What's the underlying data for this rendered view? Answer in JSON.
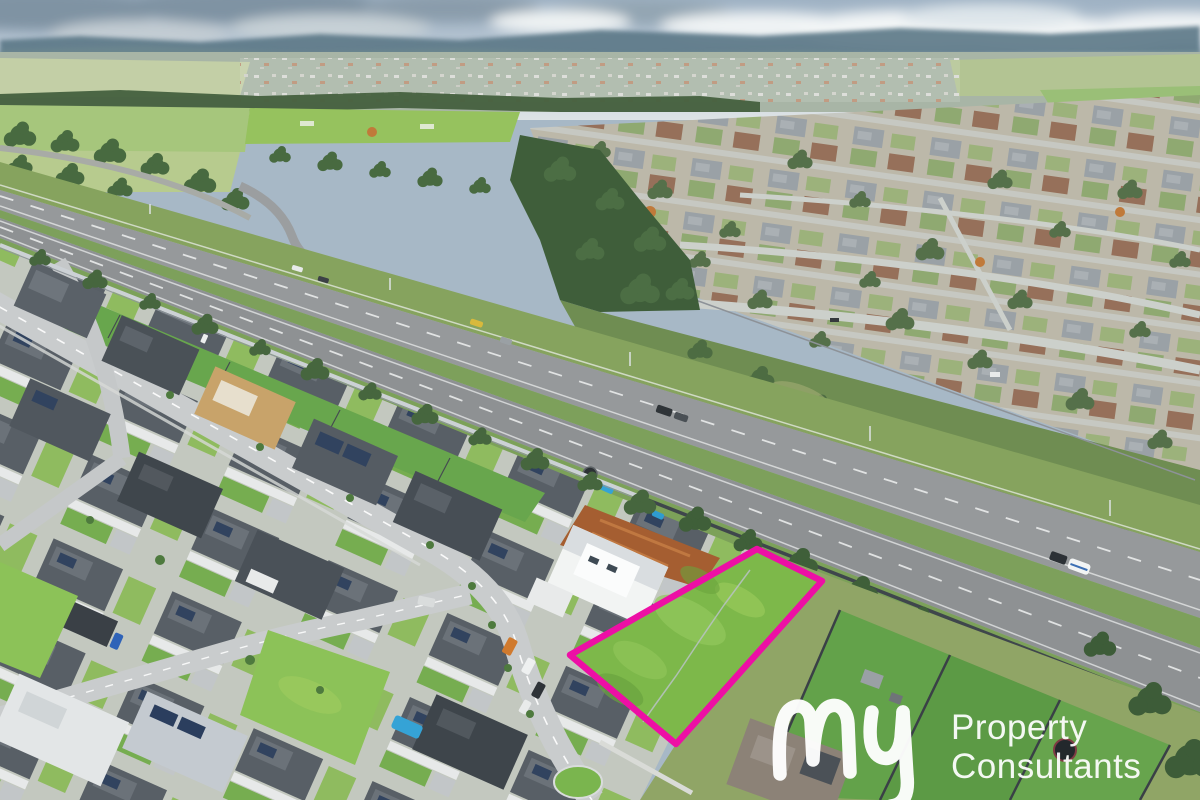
{
  "image": {
    "type": "aerial-drone-photograph",
    "description": "Aerial drone view of a new residential estate beside a divided highway, with an established suburb beyond, distant rural plains and hills under a partly cloudy sky. A vacant grass land lot in the foreground is outlined in bright magenta. A white real-estate watermark logo sits at bottom right.",
    "width": 1200,
    "height": 800
  },
  "watermark": {
    "script_word": "my",
    "line1": "Property",
    "line2": "Consultants",
    "color": "#ffffff"
  },
  "featured_lot": {
    "outline_color": "#ED0FA5",
    "fill_color": "#7db84a",
    "points": "757,549 822,581 676,744 570,655",
    "shape": "quadrilateral vacant grass lot"
  },
  "palette": {
    "sky": "#b9c7d6",
    "cloud_dark": "#7f93a3",
    "cloud_white": "#f2f5f6",
    "ridge": "#5c7887",
    "far_field": "#c3cfa6",
    "bright_field": "#96c25e",
    "tree_dark": "#3f5e3a",
    "highway_asphalt": "#96999b",
    "median_grass": "#7da05b",
    "sound_wall": "#ccd1d5",
    "dark_fence": "#3f464c",
    "estate_roof": "#565e66",
    "lawn": "#6fae4e",
    "vacant_lot_green": "#8cc258",
    "dirt": "#a55e31",
    "pool_blue": "#35a3d6",
    "terracotta": "#a5613f"
  }
}
